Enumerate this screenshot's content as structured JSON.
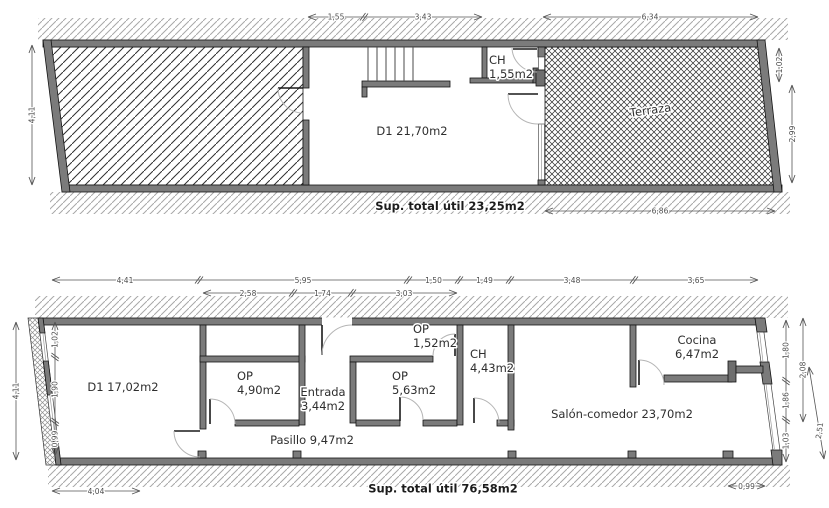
{
  "document": {
    "type": "floor-plan drawing",
    "background": "#ffffff"
  },
  "colors": {
    "wall_fill": "#7b7b7b",
    "dimension_lines": "#555555",
    "room_labels": "#2e2e2e",
    "hatch_dark": "#303030",
    "door_arc": "#b5b5b5"
  },
  "plan_upper": {
    "room_d1": "D1 21,70m2",
    "room_ch_abbr": "CH",
    "room_ch_area": "1,55m2",
    "room_terraza": "Terraza",
    "dim_top": [
      "1,55",
      "3,43",
      "6,34"
    ],
    "dim_left": "4,11",
    "dim_right": [
      "1,02",
      "2,99"
    ],
    "dim_bottom": "6,86",
    "total": "Sup. total útil 23,25m2"
  },
  "plan_lower": {
    "room_d1": "D1 17,02m2",
    "room_op1_abbr": "OP",
    "room_op1_area": "4,90m2",
    "room_entrada_name": "Entrada",
    "room_entrada_area": "3,44m2",
    "room_op2_abbr": "OP",
    "room_op2_area": "5,63m2",
    "room_op3_abbr": "OP",
    "room_op3_area": "1,52m2",
    "room_ch_abbr": "CH",
    "room_ch_area": "4,43m2",
    "room_cocina_name": "Cocina",
    "room_cocina_area": "6,47m2",
    "room_salon": "Salón-comedor 23,70m2",
    "room_pasillo": "Pasillo 9,47m2",
    "dim_top_row1": [
      "4,41",
      "5,95",
      "1,50",
      "1,49",
      "3,48",
      "3,65"
    ],
    "dim_top_row2": [
      "2,58",
      "1,74",
      "3,03"
    ],
    "dim_left_outer": "4,11",
    "dim_left_inner": [
      "1,02",
      "1,90",
      "0,99"
    ],
    "dim_right_inner": [
      "1,80",
      "1,86",
      "1,03"
    ],
    "dim_right_outer": "2,08",
    "dim_right_diag": "2,51",
    "dim_bottom_left": "4,04",
    "dim_bottom_right": "0,99",
    "total": "Sup. total útil 76,58m2"
  }
}
